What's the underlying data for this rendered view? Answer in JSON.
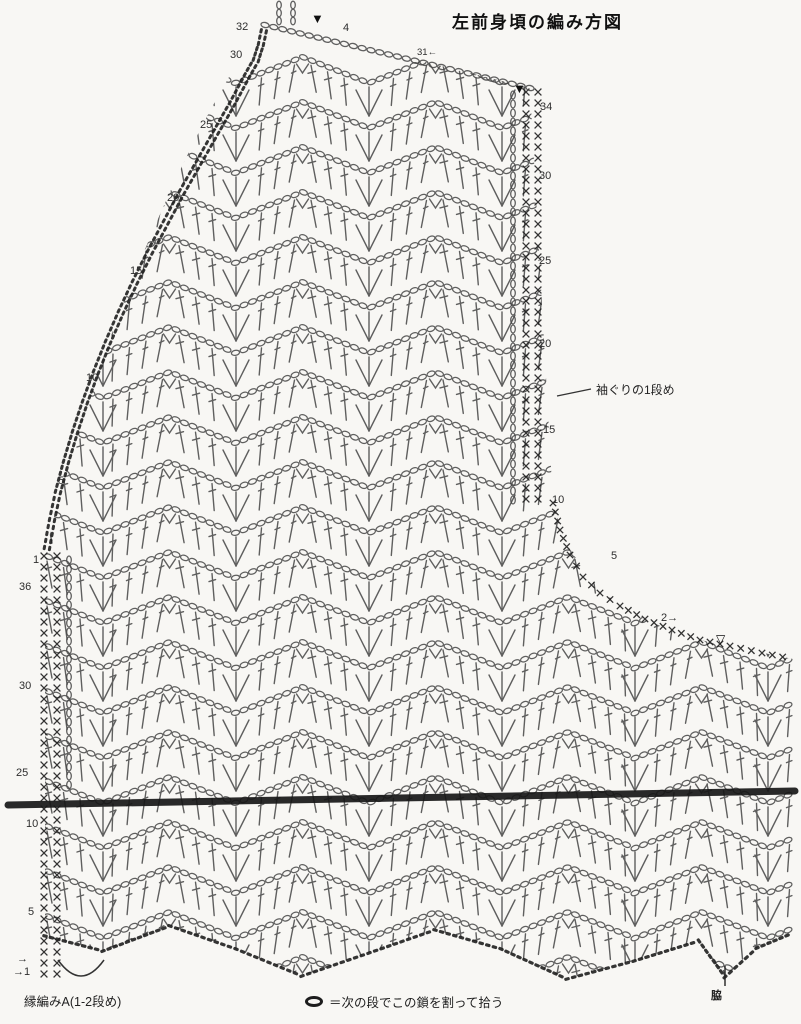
{
  "title": "左前身頃の編み方図",
  "annotations": {
    "armhole_row": "袖ぐりの1段め",
    "edging": "縁編みA(1-2段め)",
    "side": "脇"
  },
  "legend": {
    "symbol_name": "chain-oval-icon",
    "text": "＝次の段でこの鎖を割って拾う"
  },
  "row_numbers": [
    {
      "label": "32",
      "x": 236,
      "y": 22
    },
    {
      "label": "30",
      "x": 230,
      "y": 50
    },
    {
      "label": "25",
      "x": 200,
      "y": 120
    },
    {
      "label": "20",
      "x": 167,
      "y": 193
    },
    {
      "label": "15",
      "x": 130,
      "y": 266
    },
    {
      "label": "10",
      "x": 86,
      "y": 373
    },
    {
      "label": "5",
      "x": 58,
      "y": 476
    },
    {
      "label": "1",
      "x": 33,
      "y": 555
    },
    {
      "label": "36",
      "x": 19,
      "y": 582
    },
    {
      "label": "30",
      "x": 19,
      "y": 681
    },
    {
      "label": "25",
      "x": 16,
      "y": 768
    },
    {
      "label": "10",
      "x": 26,
      "y": 819
    },
    {
      "label": "5",
      "x": 28,
      "y": 907
    },
    {
      "label": "→",
      "x": 17,
      "y": 954
    },
    {
      "label": "→1",
      "x": 13,
      "y": 967
    },
    {
      "label": "4",
      "x": 343,
      "y": 23
    },
    {
      "label": "31←",
      "x": 417,
      "y": 48,
      "small": true
    },
    {
      "label": "34",
      "x": 540,
      "y": 102
    },
    {
      "label": "30",
      "x": 539,
      "y": 171
    },
    {
      "label": "25",
      "x": 539,
      "y": 256
    },
    {
      "label": "20",
      "x": 539,
      "y": 339
    },
    {
      "label": "15",
      "x": 543,
      "y": 425
    },
    {
      "label": "10",
      "x": 552,
      "y": 495
    },
    {
      "label": "5",
      "x": 611,
      "y": 551
    },
    {
      "label": "2→",
      "x": 661,
      "y": 613
    }
  ],
  "markers": [
    {
      "name": "filled-triangle-marker",
      "glyph": "▼",
      "x": 311,
      "y": 12,
      "size": 13
    },
    {
      "name": "filled-triangle-marker",
      "glyph": "▼",
      "x": 513,
      "y": 82,
      "size": 13
    },
    {
      "name": "open-triangle-marker",
      "glyph": "▽",
      "x": 716,
      "y": 633,
      "size": 12
    }
  ],
  "colors": {
    "stitch": "#454545",
    "edge": "#1f1f1f",
    "text": "#2e2e2e",
    "background": "#f8f7f4"
  },
  "geometry": {
    "outline_path": "M265,22 L530,88 L553,503 C565,548 588,583 615,601 C642,619 668,631 700,640 L793,659 L793,933 L757,948 L725,977 L699,941 L634,961 L567,979 L501,949 L435,930 L369,953 L302,976 L236,949 L170,926 L103,951 L45,936 L45,560 L47,548 C70,430 170,150 265,22 Z",
    "bands": {
      "y_start": 70,
      "y_step": 45,
      "count": 21,
      "amplitude": 13
    },
    "wave": {
      "valley_x0": 103,
      "half_period": 66.5
    },
    "beads": {
      "spacing": 8.5,
      "rx": 4.1,
      "ry": 2.5
    },
    "strokes": {
      "spacing": 16.5,
      "length": 27
    },
    "diagonal_edge": [
      [
        47,
        548
      ],
      [
        52,
        520
      ],
      [
        58,
        492
      ],
      [
        66,
        462
      ],
      [
        75,
        432
      ],
      [
        85,
        402
      ],
      [
        96,
        372
      ],
      [
        108,
        342
      ],
      [
        121,
        312
      ],
      [
        135,
        282
      ],
      [
        150,
        252
      ],
      [
        166,
        222
      ],
      [
        182,
        192
      ],
      [
        199,
        162
      ],
      [
        216,
        132
      ],
      [
        232,
        104
      ],
      [
        247,
        76
      ],
      [
        256,
        60
      ],
      [
        261,
        44
      ],
      [
        265,
        25
      ]
    ],
    "armhole_edge": [
      [
        553,
        503
      ],
      [
        560,
        530
      ],
      [
        570,
        555
      ],
      [
        583,
        577
      ],
      [
        600,
        593
      ],
      [
        620,
        606
      ],
      [
        645,
        619
      ],
      [
        672,
        630
      ],
      [
        700,
        640
      ],
      [
        730,
        646
      ],
      [
        762,
        653
      ],
      [
        793,
        659
      ]
    ],
    "top_edge": {
      "a": [
        265,
        25
      ],
      "b": [
        530,
        88
      ]
    },
    "right_edge": {
      "x_cols": [
        526,
        538
      ],
      "bead_col": 513,
      "y0": 92,
      "y1": 503
    },
    "left_edge": {
      "x_cols": [
        44,
        57
      ],
      "bead_col": 69,
      "y0": 556,
      "y1": 982,
      "bead_y1": 788
    },
    "bottom_chain": [
      [
        45,
        936
      ],
      [
        103,
        951
      ],
      [
        170,
        926
      ],
      [
        236,
        949
      ],
      [
        302,
        976
      ],
      [
        369,
        953
      ],
      [
        435,
        930
      ],
      [
        501,
        949
      ],
      [
        567,
        979
      ],
      [
        634,
        961
      ],
      [
        699,
        941
      ],
      [
        725,
        977
      ],
      [
        757,
        948
      ],
      [
        793,
        933
      ]
    ],
    "divider": {
      "x0": 8,
      "y0": 805,
      "x1": 795,
      "y1": 791,
      "width": 7
    },
    "brace_path": "M58,960 Q81,992 104,960",
    "leader_line": [
      [
        557,
        396
      ],
      [
        591,
        389
      ]
    ],
    "side_tick": [
      [
        725,
        966
      ],
      [
        725,
        986
      ]
    ],
    "mini_cols": {
      "xs": [
        279,
        293
      ],
      "y0": 2,
      "y1": 26
    }
  }
}
